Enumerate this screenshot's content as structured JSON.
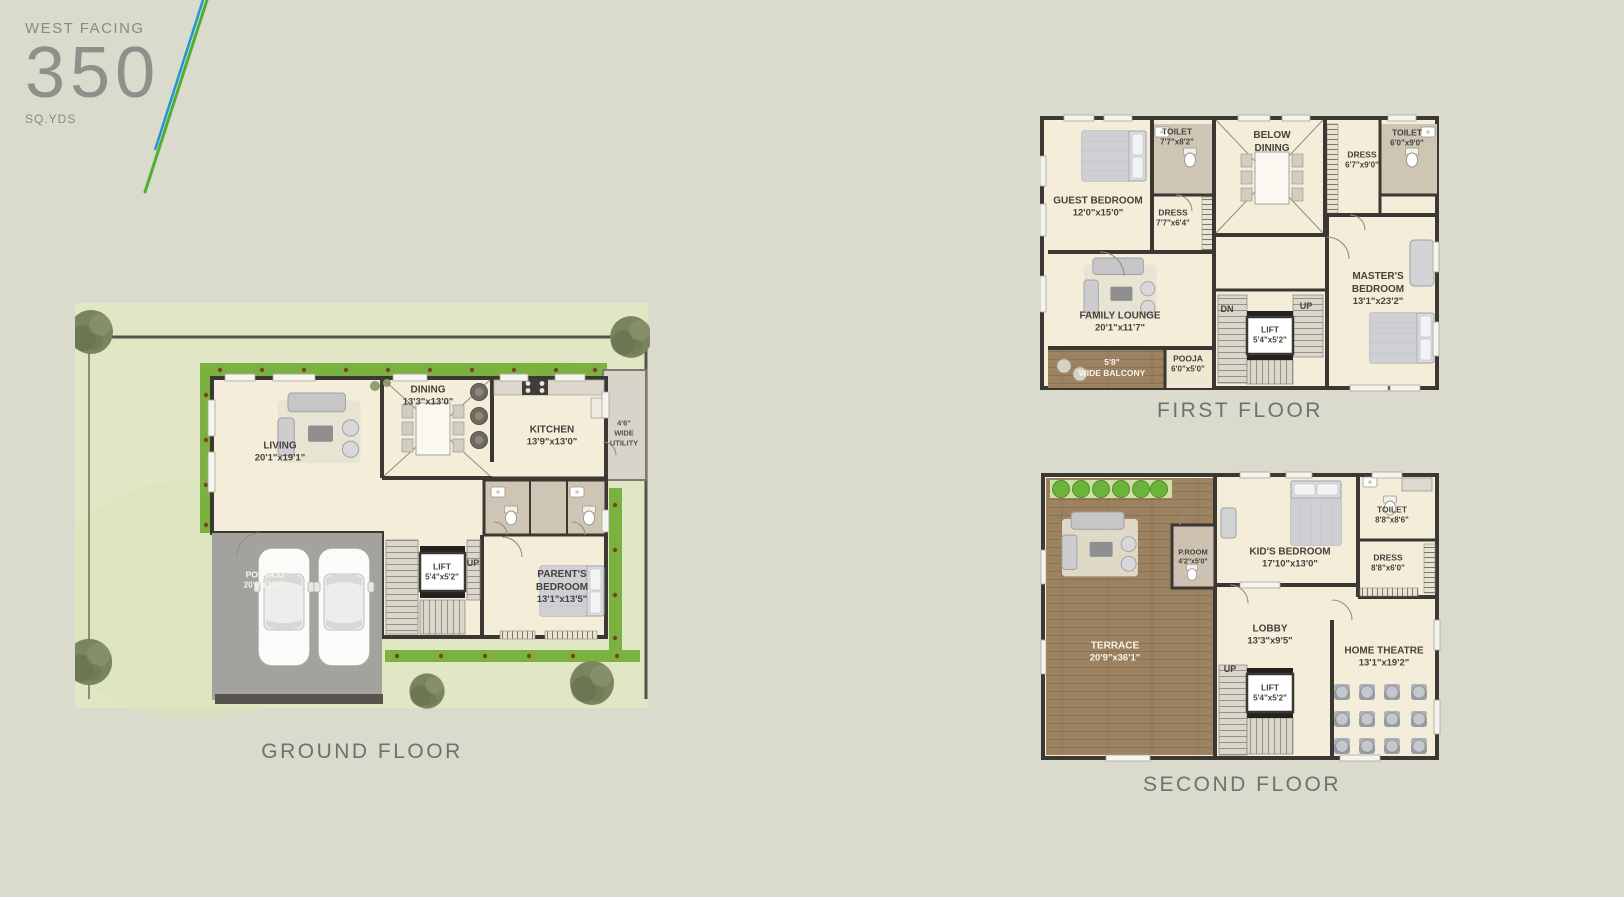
{
  "palette": {
    "background": "#dadacd",
    "floor_cream": "#f3edda",
    "wall_dark": "#3b3733",
    "hedge_green": "#7bb23f",
    "lawn_green": "#e1e7c5",
    "wood_brown": "#9d8262",
    "portico_gray": "#a4a29e",
    "toilet_taupe": "#cfc5b4",
    "accent_blue": "#2196d6",
    "accent_green": "#52ae32",
    "label_text": "#46423c",
    "title_text": "#6c736e"
  },
  "header": {
    "facing": "WEST FACING",
    "area_value": "350",
    "area_unit": "SQ.YDS"
  },
  "floors": {
    "ground": {
      "title": "GROUND FLOOR",
      "rooms": {
        "living": {
          "name": "LIVING",
          "dim": "20'1\"x19'1\""
        },
        "dining": {
          "name": "DINING",
          "dim": "13'3\"x13'0\""
        },
        "kitchen": {
          "name": "KITCHEN",
          "dim": "13'9\"x13'0\""
        },
        "utility": {
          "line1": "4'6\"",
          "line2": "WIDE",
          "line3": "UTILITY"
        },
        "portico": {
          "name": "PORTICO",
          "dim": "20'9\"x20'7\""
        },
        "lift": {
          "name": "LIFT",
          "dim": "5'4\"x5'2\""
        },
        "parents_bedroom": {
          "line1": "PARENT'S",
          "line2": "BEDROOM",
          "dim": "13'1\"x13'5\""
        },
        "up": "UP"
      }
    },
    "first": {
      "title": "FIRST FLOOR",
      "rooms": {
        "guest_bedroom": {
          "name": "GUEST BEDROOM",
          "dim": "12'0\"x15'0\""
        },
        "toilet_a": {
          "name": "TOILET",
          "dim": "7'7\"x8'2\""
        },
        "dress_a": {
          "name": "DRESS",
          "dim": "7'7\"x6'4\""
        },
        "below_dining": {
          "line1": "BELOW",
          "line2": "DINING"
        },
        "dress_b": {
          "name": "DRESS",
          "dim": "6'7\"x9'0\""
        },
        "toilet_b": {
          "name": "TOILET",
          "dim": "6'0\"x9'0\""
        },
        "masters_bedroom": {
          "line1": "MASTER'S",
          "line2": "BEDROOM",
          "dim": "13'1\"x23'2\""
        },
        "family_lounge": {
          "name": "FAMILY LOUNGE",
          "dim": "20'1\"x11'7\""
        },
        "balcony": {
          "dim": "5'8\"",
          "name": "WIDE BALCONY"
        },
        "pooja": {
          "name": "POOJA",
          "dim": "6'0\"x5'0\""
        },
        "lift": {
          "name": "LIFT",
          "dim": "5'4\"x5'2\""
        },
        "dn": "DN",
        "up": "UP"
      }
    },
    "second": {
      "title": "SECOND FLOOR",
      "rooms": {
        "terrace": {
          "name": "TERRACE",
          "dim": "20'9\"x36'1\""
        },
        "p_room": {
          "name": "P.ROOM",
          "dim": "4'2\"x5'0\""
        },
        "kids_bedroom": {
          "name": "KID'S BEDROOM",
          "dim": "17'10\"x13'0\""
        },
        "toilet": {
          "name": "TOILET",
          "dim": "8'8\"x8'6\""
        },
        "dress": {
          "name": "DRESS",
          "dim": "8'8\"x6'0\""
        },
        "lobby": {
          "name": "LOBBY",
          "dim": "13'3\"x9'5\""
        },
        "home_theatre": {
          "name": "HOME THEATRE",
          "dim": "13'1\"x19'2\""
        },
        "lift": {
          "name": "LIFT",
          "dim": "5'4\"x5'2\""
        },
        "up": "UP"
      }
    }
  }
}
